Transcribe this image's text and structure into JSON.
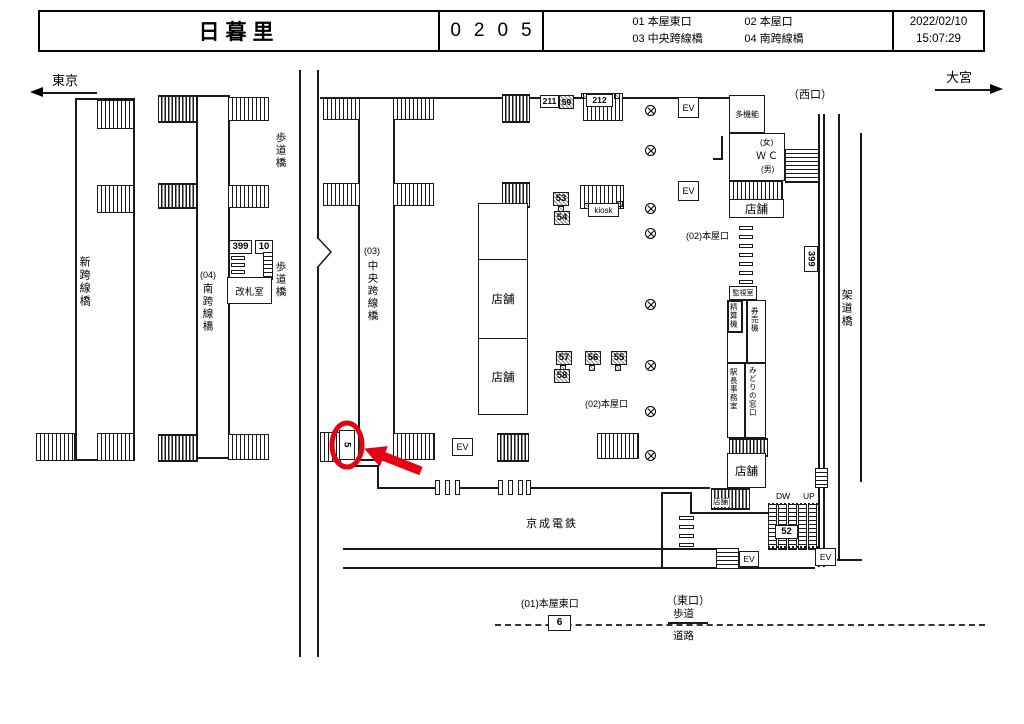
{
  "header": {
    "station": "日暮里",
    "code": "0205",
    "camera_groups_row1": [
      "01 本屋東口",
      "02 本屋口"
    ],
    "camera_groups_row2": [
      "03 中央跨線橋",
      "04 南跨線橋"
    ],
    "date": "2022/02/10",
    "time": "15:07:29"
  },
  "directions": {
    "west": "東京",
    "east": "大宮"
  },
  "exits": {
    "west": "（西口）",
    "east": "（東口）"
  },
  "bridges": {
    "shin": "新跨線橋",
    "minami_no": "(04)",
    "minami": "南跨線橋",
    "chuo_no": "(03)",
    "chuo": "中央跨線橋",
    "hodokyo": "歩道橋",
    "kadokyo": "架道橋"
  },
  "rooms": {
    "kaisatsu": "改札室",
    "tenpo": "店舗",
    "kiosk": "kiosk",
    "tamokino": "多機能",
    "wc_female": "(女)",
    "wc": "ＷＣ",
    "wc_male": "(男)",
    "kanshi": "監視室",
    "seisanki": "精算機",
    "kenbaiki": "券売機",
    "ekicho": "駅長事務室",
    "midori": "みどりの窓口"
  },
  "gates": {
    "honyaguchi_02": "(02)本屋口",
    "honya_higashi_01": "(01)本屋東口"
  },
  "misc": {
    "ev": "EV",
    "dw": "DW",
    "up": "UP",
    "keisei": "京成電鉄",
    "hodo": "歩道",
    "doro": "道路"
  },
  "cameras": {
    "c5": "5",
    "c6": "6",
    "c10": "10",
    "c52": "52",
    "c53": "53",
    "c54": "54",
    "c55": "55",
    "c56": "56",
    "c57": "57",
    "c58": "58",
    "c59": "59",
    "c211": "211",
    "c212": "212",
    "c399_gate": "399",
    "c399_track": "399"
  },
  "annotation": {
    "highlighted_camera": "5",
    "color": "#e60012"
  }
}
